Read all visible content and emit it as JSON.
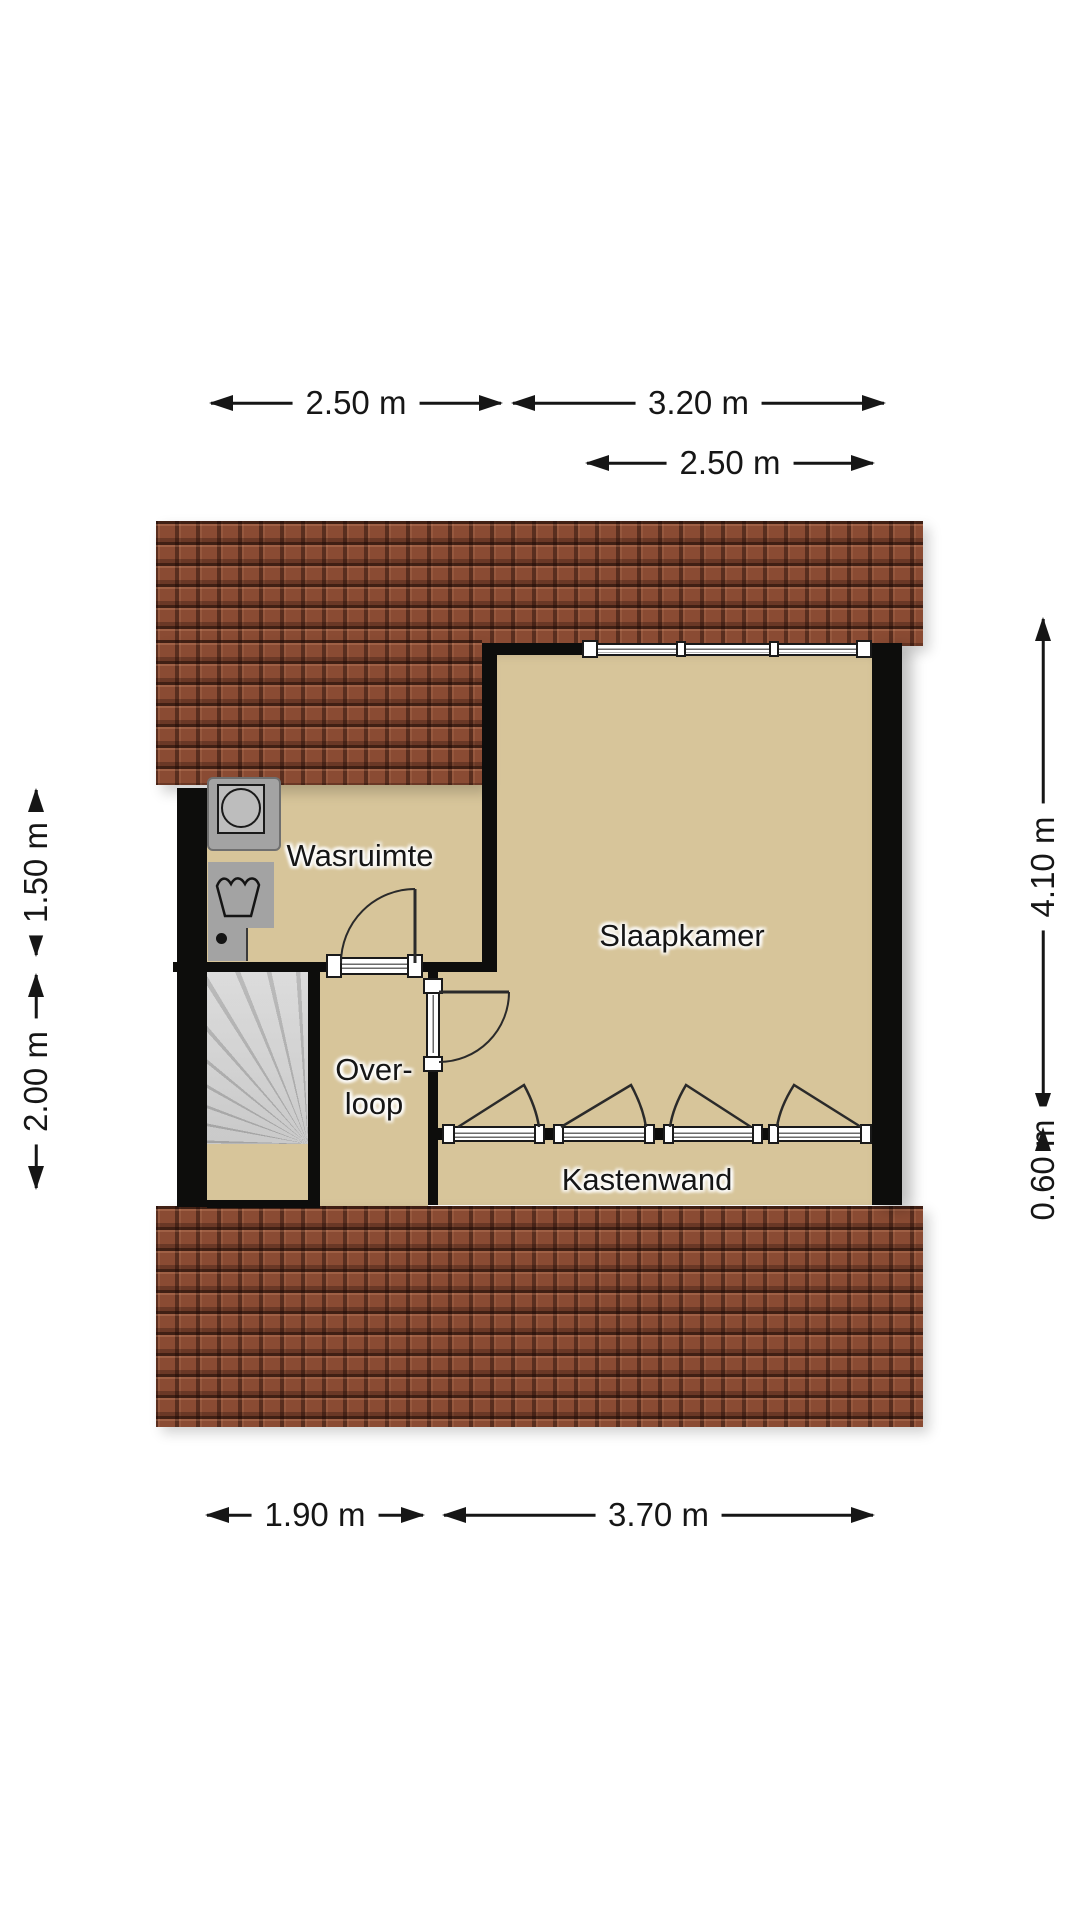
{
  "title": "Floor plan",
  "rooms": {
    "wasruimte": {
      "label": "Wasruimte"
    },
    "slaapkamer": {
      "label": "Slaapkamer"
    },
    "overloop": {
      "line1": "Over-",
      "line2": "loop"
    },
    "kastenwand": {
      "label": "Kastenwand"
    }
  },
  "dimensions": {
    "top_left": {
      "label": "2.50 m"
    },
    "top_right": {
      "label": "3.20 m"
    },
    "top_window": {
      "label": "2.50 m"
    },
    "left_upper": {
      "label": "1.50 m"
    },
    "left_lower": {
      "label": "2.00 m"
    },
    "right_upper": {
      "label": "4.10 m"
    },
    "right_lower": {
      "label": "0.60 m"
    },
    "bottom_left": {
      "label": "1.90 m"
    },
    "bottom_right": {
      "label": "3.70 m"
    }
  },
  "icons": {
    "washing_machine": "washing-machine-icon",
    "sink": "sink-icon",
    "stairs": "stairs-icon"
  },
  "colors": {
    "roof": "#8a4b33",
    "floor": "#d7c59a",
    "wall": "#0d0d0c",
    "stairs": "#bcbcbc",
    "appliance": "#a3a3a3",
    "line": "#161616"
  }
}
